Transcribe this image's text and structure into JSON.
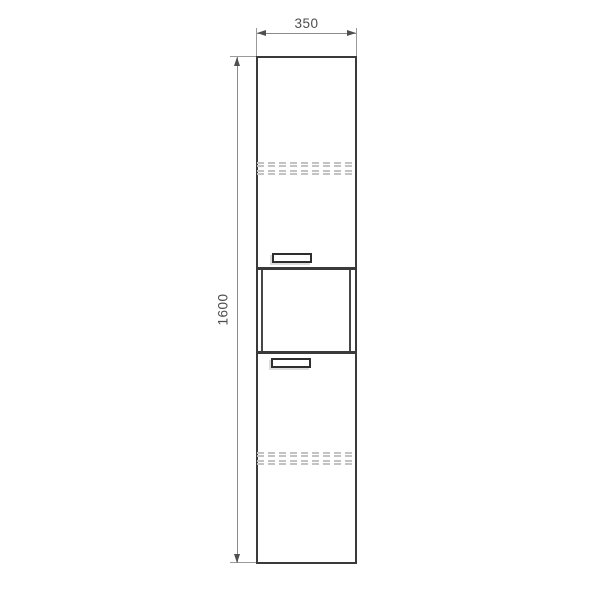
{
  "dimensions": {
    "width_label": "350",
    "height_label": "1600"
  },
  "colors": {
    "background": "#ffffff",
    "cabinet_outline": "#3a3a3a",
    "dimension_line": "#8a8a8a",
    "dimension_text": "#4d4d4d",
    "hidden_shelf_line": "#c3c3c3",
    "handle_shadow": "#dcdcdc"
  }
}
